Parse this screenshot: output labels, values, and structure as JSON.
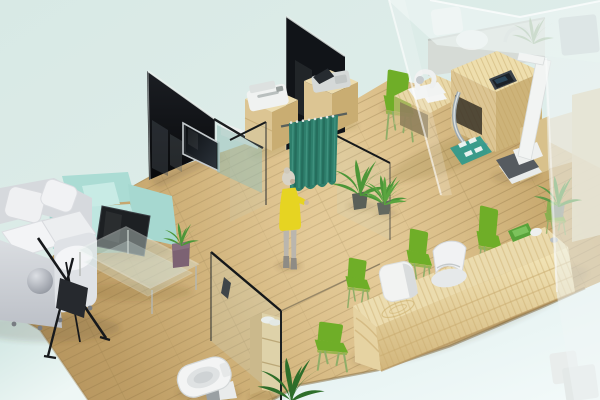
{
  "scene": {
    "title": "3D isometric interior render of a small clinic office",
    "description": "Isometric 3D rendering of a clinic interior: gray lounge sofa and mint armchair with glass coffee table, dark glass partitions with wall TV, teal privacy curtain with a woman in a yellow dress, wooden exam desks with devices, height scale, frosted glass wall, long wooden reception counter with green waiting chairs, and a glass-walled toilet room, all on a wooden plank floor over a pale mint background."
  },
  "palette": {
    "background_mint": "#d8e9e5",
    "background_mint_deep": "#cbe3df",
    "background_light": "#f3fafa",
    "floor_wood": "#c9a96e",
    "floor_wood_light": "#ddc18b",
    "floor_wood_dark": "#a8894f",
    "partition_black": "#111418",
    "frost_white": "#eff6f5",
    "glass_tint": "#bcd4cd",
    "curtain_teal": "#2e7f6c",
    "chair_green": "#6fae28",
    "sofa_gray": "#d6d9dd",
    "cushion_white": "#f1f2f4",
    "armchair_mint": "#abdcd4",
    "dress_yellow": "#e6d422",
    "furniture_wood": "#e9d9ab",
    "furniture_wood_dark": "#c9ad72",
    "device_white": "#f0f2f1",
    "screen_dark": "#1c2126",
    "chrome_silver": "#a6b0b4",
    "plant_green": "#4c9638",
    "toilet_white": "#f3f4f4",
    "vase_plum": "#7c6273"
  },
  "objects": {
    "floor": {
      "label": "wooden plank floor"
    },
    "sofa": {
      "label": "light gray lounge sofa with white cushions"
    },
    "ball_cushion": {
      "label": "round gray ball cushion"
    },
    "armchair": {
      "label": "mint green armchair"
    },
    "lounge_tv": {
      "label": "dark flat screen facing the lounge"
    },
    "banner_stand": {
      "label": "black tripod display stand"
    },
    "coffee_table": {
      "label": "glass coffee table"
    },
    "table_plant": {
      "label": "potted plant in plum vase"
    },
    "partition_left": {
      "label": "dark glass partition wall"
    },
    "wall_tv": {
      "label": "wall mounted TV"
    },
    "partition_center": {
      "label": "tall dark glass partition"
    },
    "whiteboard": {
      "label": "white board behind glass"
    },
    "teal_glass": {
      "label": "teal tinted glass pane"
    },
    "cabinet_printer": {
      "label": "wooden cabinet with white printer"
    },
    "cabinet_console": {
      "label": "wooden cabinet with monitor console"
    },
    "curtain": {
      "label": "teal privacy curtain on rail"
    },
    "person": {
      "label": "woman in yellow dress at the curtain"
    },
    "floor_plants": {
      "label": "potted floor plants"
    },
    "glass_partitions": {
      "label": "clear glass partition panels"
    },
    "exam_desk": {
      "label": "wooden exam desk with microscope device"
    },
    "exam_counter": {
      "label": "wooden exam counter with tablet and chrome fitting"
    },
    "exam_chair": {
      "label": "green exam chair"
    },
    "height_scale": {
      "label": "white height scale with dark platform"
    },
    "floor_mat": {
      "label": "teal floor mat with white squares"
    },
    "back_counter": {
      "label": "blurred back counter with equipment"
    },
    "slat_cabinet": {
      "label": "wooden slat cabinet"
    },
    "frosted_wall": {
      "label": "frosted glass wall"
    },
    "reception_desk": {
      "label": "long wooden reception counter"
    },
    "reception_chairs": {
      "label": "green waiting chairs"
    },
    "white_stool": {
      "label": "white cube stool"
    },
    "white_chair": {
      "label": "white reception chair"
    },
    "desk_tray": {
      "label": "green tray and white mouse on counter"
    },
    "toilet_room": {
      "label": "glass walled toilet room"
    },
    "toilet": {
      "label": "white toilet"
    },
    "bath_shelf": {
      "label": "wooden shelf with towels"
    }
  }
}
